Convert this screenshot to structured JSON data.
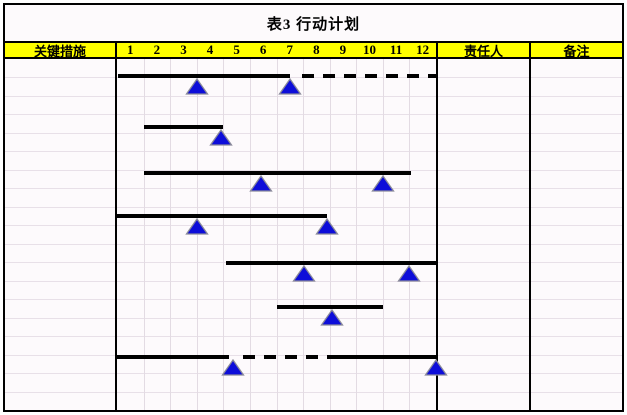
{
  "title": "表3 行动计划",
  "header": {
    "col_measures": "关键措施",
    "months": [
      "1",
      "2",
      "3",
      "4",
      "5",
      "6",
      "7",
      "8",
      "9",
      "10",
      "11",
      "12"
    ],
    "col_owner": "责任人",
    "col_notes": "备注"
  },
  "colors": {
    "header_bg": "#ffff00",
    "table_bg": "#fdfafc",
    "grid_line": "#e8e0e8",
    "border": "#000000",
    "bar": "#000000",
    "milestone_fill": "#0d0dd9",
    "milestone_edge": "#8a8a9a"
  },
  "chart_data": {
    "type": "gantt",
    "title": "表3 行动计划",
    "x_unit": "month",
    "x_ticks": [
      "1",
      "2",
      "3",
      "4",
      "5",
      "6",
      "7",
      "8",
      "9",
      "10",
      "11",
      "12"
    ],
    "x_range": [
      0,
      12
    ],
    "grid": true,
    "tasks": [
      {
        "segments": [
          {
            "style": "solid",
            "start": 0.05,
            "end": 6.5
          },
          {
            "style": "dashed",
            "start": 6.95,
            "end": 12.0
          }
        ],
        "milestones": [
          3.0,
          6.5
        ]
      },
      {
        "segments": [
          {
            "style": "solid",
            "start": 1.0,
            "end": 4.0
          }
        ],
        "milestones": [
          3.9
        ]
      },
      {
        "segments": [
          {
            "style": "solid",
            "start": 1.0,
            "end": 11.05
          }
        ],
        "milestones": [
          5.4,
          10.0
        ]
      },
      {
        "segments": [
          {
            "style": "solid",
            "start": 0.0,
            "end": 7.9
          }
        ],
        "milestones": [
          3.0,
          7.9
        ]
      },
      {
        "segments": [
          {
            "style": "solid",
            "start": 4.1,
            "end": 12.0
          }
        ],
        "milestones": [
          7.05,
          11.0
        ]
      },
      {
        "segments": [
          {
            "style": "solid",
            "start": 6.0,
            "end": 10.0
          }
        ],
        "milestones": [
          8.1
        ]
      },
      {
        "segments": [
          {
            "style": "solid",
            "start": 0.0,
            "end": 4.2
          },
          {
            "style": "dashed",
            "start": 4.75,
            "end": 8.0
          },
          {
            "style": "solid",
            "start": 8.0,
            "end": 12.0
          }
        ],
        "milestones": [
          4.35,
          12.0
        ]
      }
    ],
    "rows_y_px": [
      17,
      68,
      114,
      157,
      204,
      248,
      298
    ]
  }
}
